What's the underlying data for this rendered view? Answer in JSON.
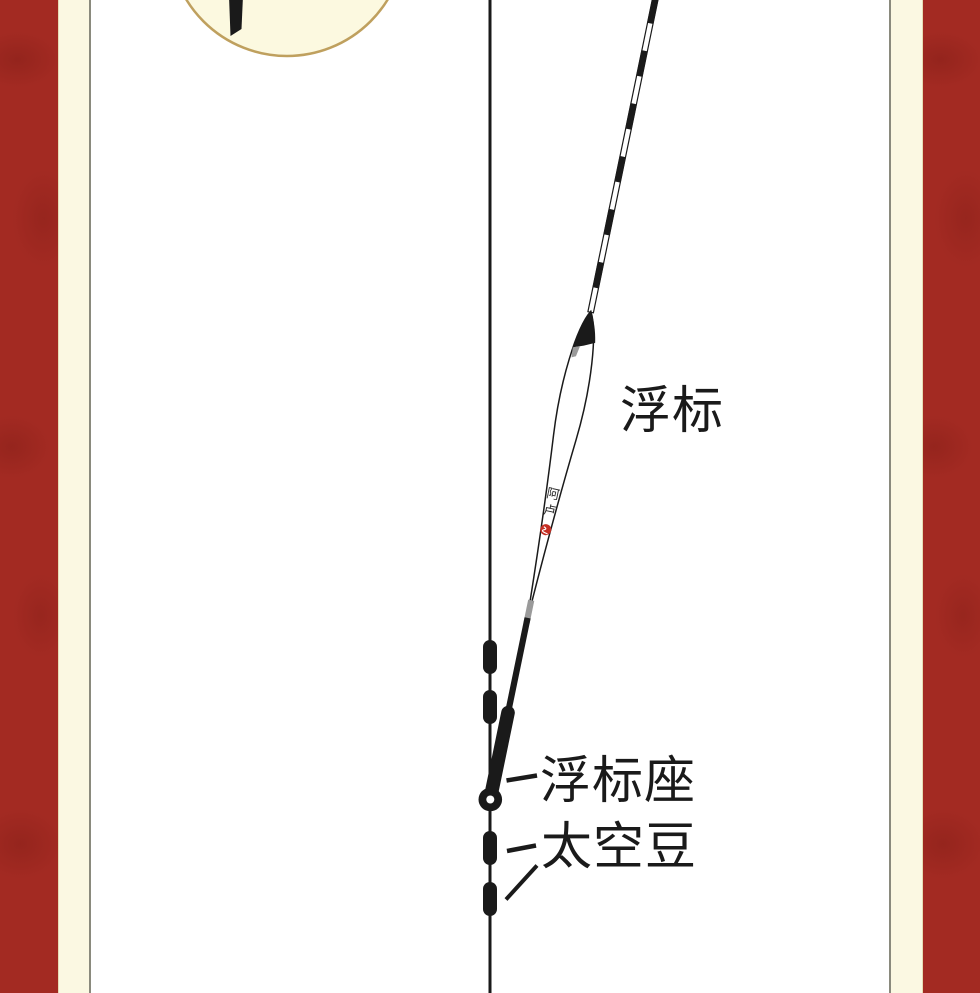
{
  "page": {
    "colors": {
      "band_red": "#a32a22",
      "cream": "#fbf8e2",
      "frame_line": "#8a8a7d",
      "inset_fill": "#fcf9e0",
      "inset_stroke": "#bfa05e",
      "ink": "#1a1a1a",
      "joint_gray": "#9a9a9a",
      "seal_red": "#c42f24"
    }
  },
  "diagram": {
    "labels": {
      "float": "浮标",
      "float_seat": "浮标座",
      "space_bean": "太空豆"
    },
    "float_brand": {
      "char_top": "阿",
      "char_bottom": "卢"
    }
  }
}
